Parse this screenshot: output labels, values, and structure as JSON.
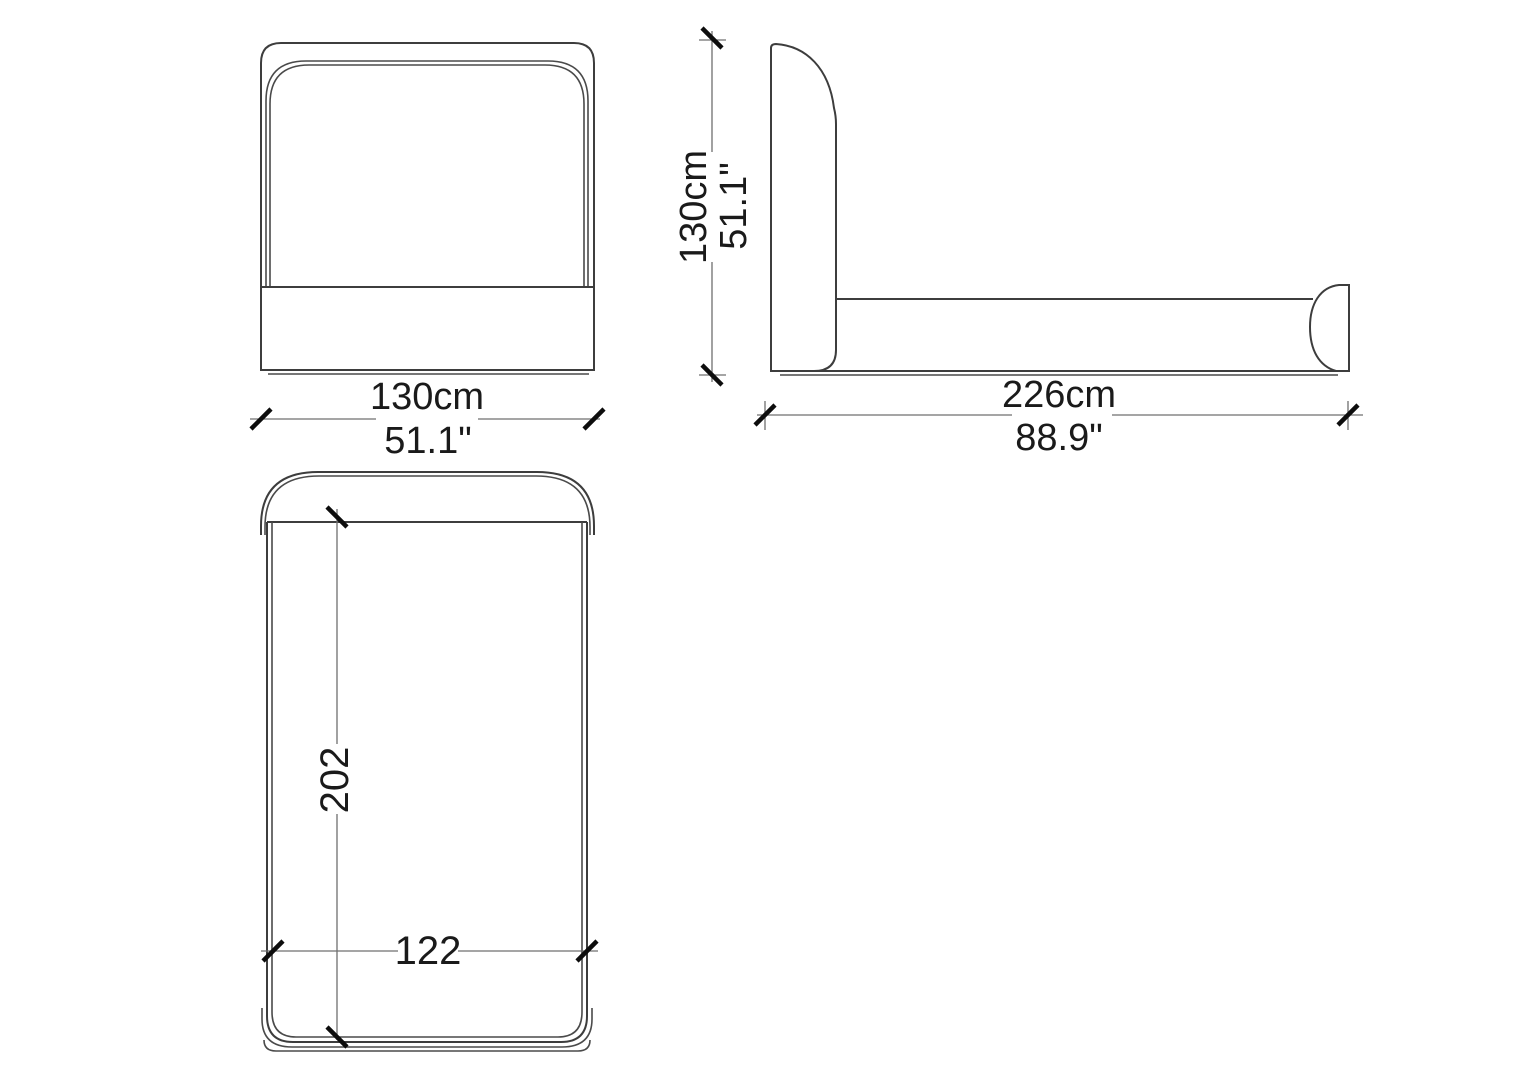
{
  "front_view": {
    "width": {
      "cm": "130cm",
      "inches": "51.1\""
    }
  },
  "side_view": {
    "height": {
      "cm": "130cm",
      "inches": "51.1\""
    },
    "length": {
      "cm": "226cm",
      "inches": "88.9\""
    }
  },
  "top_view": {
    "length_cm": "202",
    "width_cm": "122"
  },
  "colors": {
    "background": "#ffffff",
    "outline": "#3d3d3d",
    "dimension_line": "#6f6f6f",
    "tick": "#0d0d0d",
    "text": "#1a1a1a"
  }
}
